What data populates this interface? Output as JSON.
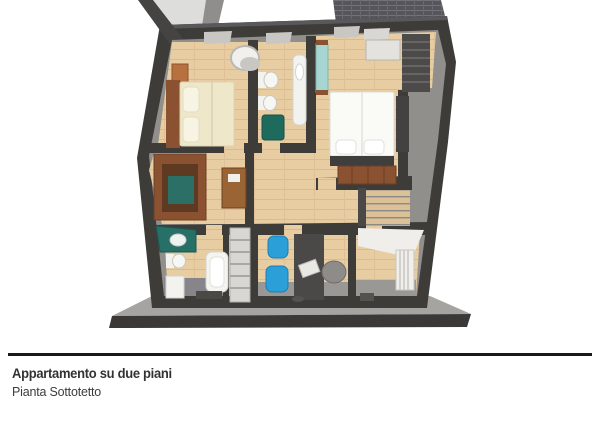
{
  "caption": {
    "title": "Appartamento su due piani",
    "subtitle": "Pianta Sottotetto"
  },
  "illustration": {
    "kind": "3d-cutaway-floor-plan",
    "icons": [
      "double-bed",
      "armchair",
      "nightstand",
      "wardrobe-window",
      "toilet",
      "bidet",
      "bathtub",
      "sink-vanity",
      "laundry-basket",
      "desk",
      "bookshelf",
      "dresser",
      "staircase",
      "office-chair",
      "blue-chair",
      "laptop",
      "radiator",
      "closet-stack"
    ]
  },
  "colors": {
    "wall_dark": "#3d3c39",
    "wall_inner_gray": "#918f8b",
    "floor_wood": "#e8cda2",
    "roof_tiles": "#56555b",
    "roof_slope_light": "#dddddb",
    "base_slab": "#a6a4a0",
    "slab_edge": "#3a3938",
    "teal_accent": "#267067",
    "teal_light": "#a7d6d2",
    "chair_blue": "#2a9fd8",
    "wood_furniture": "#8a5230",
    "bed_cream": "#efe7ca",
    "bed_white": "#fafaf7",
    "fixture_white": "#f2f2ee",
    "rule_black": "#1b1b1b",
    "text_dark": "#323232"
  }
}
